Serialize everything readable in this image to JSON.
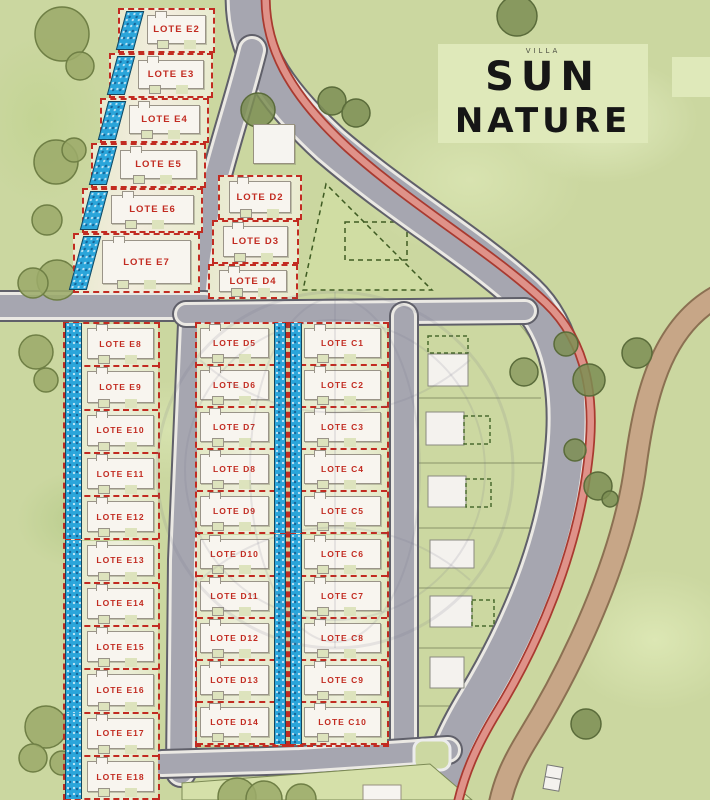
{
  "title": {
    "small_label": "VILLA",
    "line1": "SUN",
    "line2": "NATURE"
  },
  "lots": {
    "e_upper": [
      {
        "label": "LOTE E2"
      },
      {
        "label": "LOTE E3"
      },
      {
        "label": "LOTE E4"
      },
      {
        "label": "LOTE E5"
      },
      {
        "label": "LOTE E6"
      },
      {
        "label": "LOTE E7"
      }
    ],
    "d_upper": [
      {
        "label": "LOTE D2"
      },
      {
        "label": "LOTE D3"
      },
      {
        "label": "LOTE D4"
      }
    ],
    "e_column": [
      {
        "label": "LOTE E8"
      },
      {
        "label": "LOTE E9"
      },
      {
        "label": "LOTE E10"
      },
      {
        "label": "LOTE E11"
      },
      {
        "label": "LOTE E12"
      },
      {
        "label": "LOTE E13"
      },
      {
        "label": "LOTE E14"
      },
      {
        "label": "LOTE E15"
      },
      {
        "label": "LOTE E16"
      },
      {
        "label": "LOTE E17"
      },
      {
        "label": "LOTE E18"
      }
    ],
    "d_column": [
      {
        "label": "LOTE D5"
      },
      {
        "label": "LOTE D6"
      },
      {
        "label": "LOTE D7"
      },
      {
        "label": "LOTE D8"
      },
      {
        "label": "LOTE D9"
      },
      {
        "label": "LOTE D10"
      },
      {
        "label": "LOTE D11"
      },
      {
        "label": "LOTE D12"
      },
      {
        "label": "LOTE D13"
      },
      {
        "label": "LOTE D14"
      }
    ],
    "c_column": [
      {
        "label": "LOTE C1"
      },
      {
        "label": "LOTE C2"
      },
      {
        "label": "LOTE C3"
      },
      {
        "label": "LOTE C4"
      },
      {
        "label": "LOTE C5"
      },
      {
        "label": "LOTE C6"
      },
      {
        "label": "LOTE C7"
      },
      {
        "label": "LOTE C8"
      },
      {
        "label": "LOTE C9"
      },
      {
        "label": "LOTE C10"
      }
    ]
  },
  "colors": {
    "lot_border_red": "#c22b21",
    "pool_blue": "#2aa5da",
    "road_gray": "#a6a6b0",
    "path_red": "#df9289",
    "path_brown": "#c7a687",
    "grass_green": "#cbd7a0",
    "title_panel_green": "#dfe9ba",
    "tree_olive": "#9cab6a"
  }
}
